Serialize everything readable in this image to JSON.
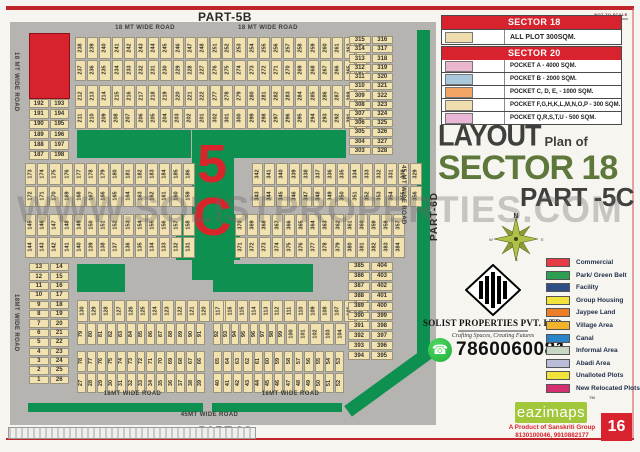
{
  "page": {
    "part_top": "PART-5B",
    "part_bottom": "PART-3C",
    "part_right": "PART-6D",
    "not_to_scale": "NOT TO SCALE",
    "watermark": "WWW.SOLISTPROPERTIES.COM",
    "page_number": "16"
  },
  "legend_table": {
    "sector18_header": "SECTOR 18",
    "all_plot_label": "ALL PLOT  300SQM.",
    "all_plot_color": "#f0ddae",
    "sector20_header": "SECTOR 20",
    "header_bg": "#d8232e",
    "pockets": [
      {
        "label": "POCKET A   -  4000 SQM.",
        "color": "#eab6cd"
      },
      {
        "label": "POCKET B   -  2000 SQM.",
        "color": "#a9c8db"
      },
      {
        "label": "POCKET C, D, E, - 1000 SQM.",
        "color": "#f2a465"
      },
      {
        "label": "POCKET  F,G,H,K,L,M,N,O,P  -  300 SQM.",
        "color": "#f0ddae"
      },
      {
        "label": "POCKET Q,R,S,T,U   -  500 SQM.",
        "color": "#eab6d6"
      }
    ]
  },
  "title": {
    "word1": "LAYOUT",
    "word2": "Plan of",
    "line2": "SECTOR 18",
    "line3": "PART -5C",
    "accent_color": "#5e783b"
  },
  "compass": {
    "north": "N",
    "east": "E",
    "south": "S",
    "west": "W"
  },
  "company": {
    "name": "SOLIST PROPERTIES PVT. LTD.",
    "tagline": "Crafting Spaces, Creating Futures",
    "phone": "7860060081",
    "whatsapp_green": "#1faf38"
  },
  "area_legend": [
    {
      "label": "Commercial",
      "color": "#e63a44"
    },
    {
      "label": "Park/ Green Belt",
      "color": "#2e9e53"
    },
    {
      "label": "Facility",
      "color": "#2d4f86"
    },
    {
      "label": "Group Housing",
      "color": "#f2e33a"
    },
    {
      "label": "Jaypee Land",
      "color": "#ee7d27"
    },
    {
      "label": "Village Area",
      "color": "#f2b32b"
    },
    {
      "label": "Canal",
      "color": "#2a85c8"
    },
    {
      "label": "Informal Area",
      "color": "#c9d8c5"
    },
    {
      "label": "Abadi Area",
      "color": "#babdd7"
    },
    {
      "label": "Unalloted Plots",
      "color": "#f2e33a"
    },
    {
      "label": "New Relocated Plots",
      "color": "#d42f6f"
    }
  ],
  "footer": {
    "brand": "eazimaps",
    "tm": "TM",
    "product_line": "A Product of Sanskriti Group",
    "phones": "8130100046, 9910882177",
    "brand_bg": "#a2c73b"
  },
  "colors": {
    "map_road": "#b6b4b1",
    "plot_fill": "#f2e2b0",
    "green_belt": "#0e9150",
    "commercial_red": "#d8232e"
  },
  "map": {
    "big_label_top": "5",
    "big_label_bottom": "C",
    "road_labels": [
      {
        "text": "18 MT WIDE ROAD",
        "x": 95,
        "y": 3,
        "w": 80,
        "o": "h"
      },
      {
        "text": "18 MT WIDE ROAD",
        "x": 218,
        "y": 3,
        "w": 80,
        "o": "h"
      },
      {
        "text": "18 MT WIDE ROAD",
        "x": 3,
        "y": 30,
        "h": 78,
        "o": "v"
      },
      {
        "text": "18MT WIDE ROAD",
        "x": 3,
        "y": 272,
        "h": 78,
        "o": "v"
      },
      {
        "text": "45 MT WIDE ROAD",
        "x": 390,
        "y": 143,
        "h": 78,
        "o": "v"
      },
      {
        "text": "18MT WIDE ROAD",
        "x": 85,
        "y": 369,
        "w": 75,
        "o": "h"
      },
      {
        "text": "18MT WIDE ROAD",
        "x": 243,
        "y": 369,
        "w": 75,
        "o": "h"
      },
      {
        "text": "45MT WIDE ROAD",
        "x": 152,
        "y": 390,
        "w": 95,
        "o": "h"
      }
    ],
    "strip_blocks": [
      {
        "id": "A",
        "x": 65,
        "y": 15,
        "w": 128,
        "h": 44,
        "rows": [
          [
            238,
            239,
            240,
            241,
            242,
            243,
            244,
            245,
            246,
            247,
            248,
            249,
            250
          ],
          [
            237,
            236,
            235,
            234,
            233,
            232,
            231,
            230,
            229,
            228,
            227,
            226,
            225
          ]
        ]
      },
      {
        "id": "B",
        "x": 200,
        "y": 15,
        "w": 123,
        "h": 44,
        "rows": [
          [
            251,
            252,
            253,
            254,
            255,
            256,
            257,
            258,
            259,
            260,
            261,
            262,
            263
          ],
          [
            276,
            275,
            274,
            273,
            272,
            271,
            270,
            269,
            268,
            267,
            266,
            265,
            264
          ]
        ]
      },
      {
        "id": "C",
        "x": 65,
        "y": 63,
        "w": 128,
        "h": 44,
        "rows": [
          [
            212,
            213,
            214,
            215,
            216,
            217,
            218,
            219,
            220,
            221,
            222,
            223,
            224
          ],
          [
            211,
            210,
            209,
            208,
            207,
            206,
            205,
            204,
            203,
            202,
            201,
            200,
            199
          ]
        ]
      },
      {
        "id": "D",
        "x": 200,
        "y": 63,
        "w": 123,
        "h": 44,
        "rows": [
          [
            277,
            278,
            279,
            280,
            281,
            282,
            283,
            284,
            285,
            286,
            287,
            288,
            289
          ],
          [
            302,
            301,
            300,
            299,
            298,
            297,
            296,
            295,
            294,
            293,
            292,
            291,
            290
          ]
        ]
      },
      {
        "id": "E",
        "x": 15,
        "y": 141,
        "w": 145,
        "h": 44,
        "rows": [
          [
            173,
            174,
            175,
            176,
            177,
            178,
            179,
            180,
            181,
            182,
            183,
            184,
            185,
            186
          ],
          [
            172,
            171,
            170,
            169,
            168,
            167,
            166,
            165,
            164,
            163,
            162,
            161,
            160,
            159
          ]
        ]
      },
      {
        "id": "F",
        "x": 242,
        "y": 141,
        "w": 141,
        "h": 44,
        "rows": [
          [
            342,
            341,
            340,
            339,
            338,
            337,
            336,
            335,
            334,
            333,
            332,
            331,
            330,
            329
          ],
          [
            343,
            344,
            345,
            346,
            347,
            348,
            349,
            350,
            351,
            352,
            353,
            354,
            355,
            356
          ]
        ]
      },
      {
        "id": "G",
        "x": 15,
        "y": 192,
        "w": 145,
        "h": 44,
        "rows": [
          [
            145,
            146,
            147,
            148,
            149,
            150,
            151,
            152,
            153,
            154,
            155,
            156,
            157,
            158
          ],
          [
            144,
            143,
            142,
            141,
            140,
            139,
            138,
            137,
            136,
            135,
            134,
            133,
            132,
            131
          ]
        ]
      },
      {
        "id": "H",
        "x": 225,
        "y": 192,
        "w": 158,
        "h": 44,
        "rows": [
          [
            370,
            369,
            368,
            367,
            366,
            365,
            364,
            363,
            362,
            361,
            360,
            359,
            358,
            357
          ],
          [
            371,
            372,
            373,
            374,
            375,
            376,
            377,
            378,
            379,
            380,
            381,
            382,
            383,
            384
          ]
        ]
      },
      {
        "id": "I",
        "x": 67,
        "y": 278,
        "w": 128,
        "h": 45,
        "rows": [
          [
            130,
            129,
            128,
            127,
            126,
            125,
            124,
            123,
            122,
            121,
            120,
            119,
            118
          ],
          [
            79,
            80,
            81,
            82,
            83,
            84,
            85,
            86,
            87,
            88,
            89,
            90,
            91
          ]
        ]
      },
      {
        "id": "J",
        "x": 203,
        "y": 278,
        "w": 123,
        "h": 45,
        "rows": [
          [
            117,
            116,
            115,
            114,
            113,
            112,
            111,
            110,
            109,
            108,
            107,
            106,
            105
          ],
          [
            92,
            93,
            94,
            95,
            96,
            97,
            98,
            99,
            100,
            101,
            102,
            103,
            104
          ]
        ]
      },
      {
        "id": "K",
        "x": 67,
        "y": 329,
        "w": 128,
        "h": 42,
        "rows": [
          [
            78,
            77,
            76,
            75,
            74,
            73,
            72,
            71,
            70,
            69,
            68,
            67,
            66
          ],
          [
            27,
            28,
            29,
            30,
            31,
            32,
            33,
            34,
            35,
            36,
            37,
            38,
            39
          ]
        ]
      },
      {
        "id": "L",
        "x": 203,
        "y": 329,
        "w": 131,
        "h": 42,
        "rows": [
          [
            65,
            64,
            63,
            62,
            61,
            60,
            59,
            58,
            57,
            56,
            55,
            54,
            53
          ],
          [
            40,
            41,
            42,
            43,
            44,
            45,
            46,
            47,
            48,
            49,
            50,
            51,
            52
          ]
        ]
      }
    ],
    "pair_blocks": [
      {
        "id": "P1",
        "x": 19,
        "y": 77,
        "w": 40,
        "h": 61,
        "rows": [
          [
            192,
            193
          ],
          [
            191,
            194
          ],
          [
            190,
            195
          ],
          [
            189,
            196
          ],
          [
            188,
            197
          ],
          [
            187,
            198
          ]
        ]
      },
      {
        "id": "P2",
        "x": 339,
        "y": 14,
        "w": 44,
        "h": 119,
        "rows": [
          [
            315,
            316
          ],
          [
            314,
            317
          ],
          [
            313,
            318
          ],
          [
            312,
            319
          ],
          [
            311,
            320
          ],
          [
            310,
            321
          ],
          [
            309,
            322
          ],
          [
            308,
            323
          ],
          [
            307,
            324
          ],
          [
            306,
            325
          ],
          [
            305,
            326
          ],
          [
            304,
            327
          ],
          [
            303,
            328
          ]
        ]
      },
      {
        "id": "P3",
        "x": 19,
        "y": 241,
        "w": 40,
        "h": 121,
        "rows": [
          [
            13,
            14
          ],
          [
            12,
            15
          ],
          [
            11,
            16
          ],
          [
            10,
            17
          ],
          [
            9,
            18
          ],
          [
            8,
            19
          ],
          [
            7,
            20
          ],
          [
            6,
            21
          ],
          [
            5,
            22
          ],
          [
            4,
            23
          ],
          [
            3,
            24
          ],
          [
            2,
            25
          ],
          [
            1,
            26
          ]
        ]
      },
      {
        "id": "P4",
        "x": 338,
        "y": 240,
        "w": 45,
        "h": 98,
        "rows": [
          [
            385,
            404
          ],
          [
            386,
            403
          ],
          [
            387,
            402
          ],
          [
            388,
            401
          ],
          [
            389,
            400
          ],
          [
            390,
            399
          ],
          [
            391,
            398
          ],
          [
            392,
            397
          ],
          [
            393,
            396
          ],
          [
            394,
            395
          ]
        ]
      }
    ]
  }
}
